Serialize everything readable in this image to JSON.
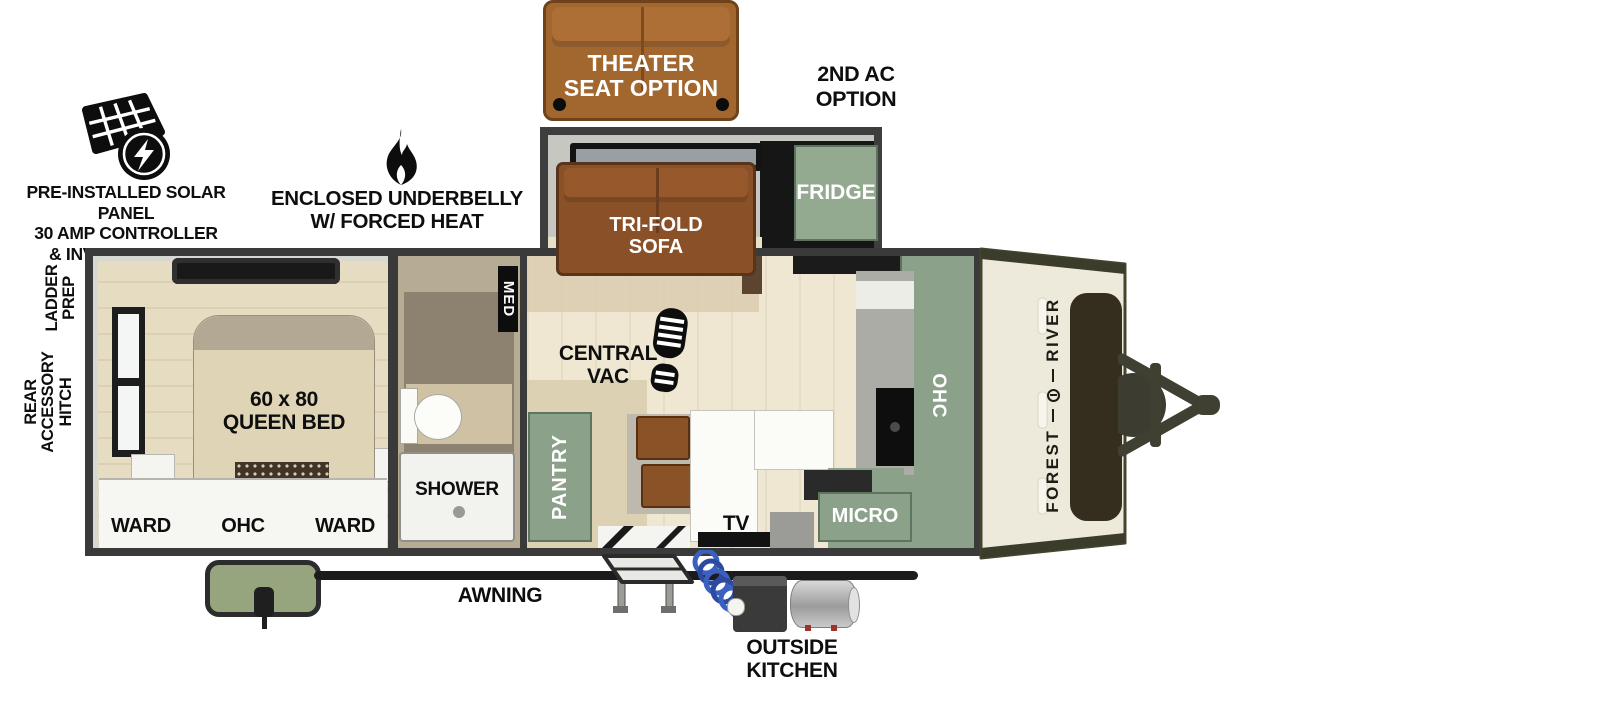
{
  "exterior": {
    "theater_seat_label": "THEATER\nSEAT OPTION",
    "second_ac_label": "2ND AC\nOPTION",
    "solar_label": "PRE-INSTALLED SOLAR PANEL\n30 AMP CONTROLLER\n& INVERTER PREP",
    "underbelly_label": "ENCLOSED UNDERBELLY\nW/ FORCED HEAT",
    "ladder_prep_label": "LADDER\nPREP",
    "rear_accessory_hitch_label": "REAR\nACCESSORY\nHITCH",
    "awning_label": "AWNING",
    "outside_kitchen_label": "OUTSIDE\nKITCHEN"
  },
  "slideout": {
    "sofa_label": "TRI-FOLD\nSOFA",
    "fridge_label": "FRIDGE"
  },
  "bedroom": {
    "bed_label": "60 x 80\nQUEEN BED",
    "ward_left_label": "WARD",
    "ohc_label": "OHC",
    "ward_right_label": "WARD"
  },
  "bathroom": {
    "med_label": "MED",
    "shower_label": "SHOWER"
  },
  "living": {
    "central_vac_label": "CENTRAL\nVAC",
    "pantry_label": "PANTRY",
    "tv_label": "TV"
  },
  "kitchen": {
    "micro_label": "MICRO",
    "ohc_label": "OHC"
  },
  "brand": {
    "forest": "FOREST",
    "river": "RIVER"
  },
  "colors": {
    "cabinet_sage": "#8ba189",
    "sofa_brown": "#8a5128",
    "theater_brown": "#a2662f",
    "wall_dark": "#3a3a3a",
    "front_cap_cream": "#edeadb"
  }
}
